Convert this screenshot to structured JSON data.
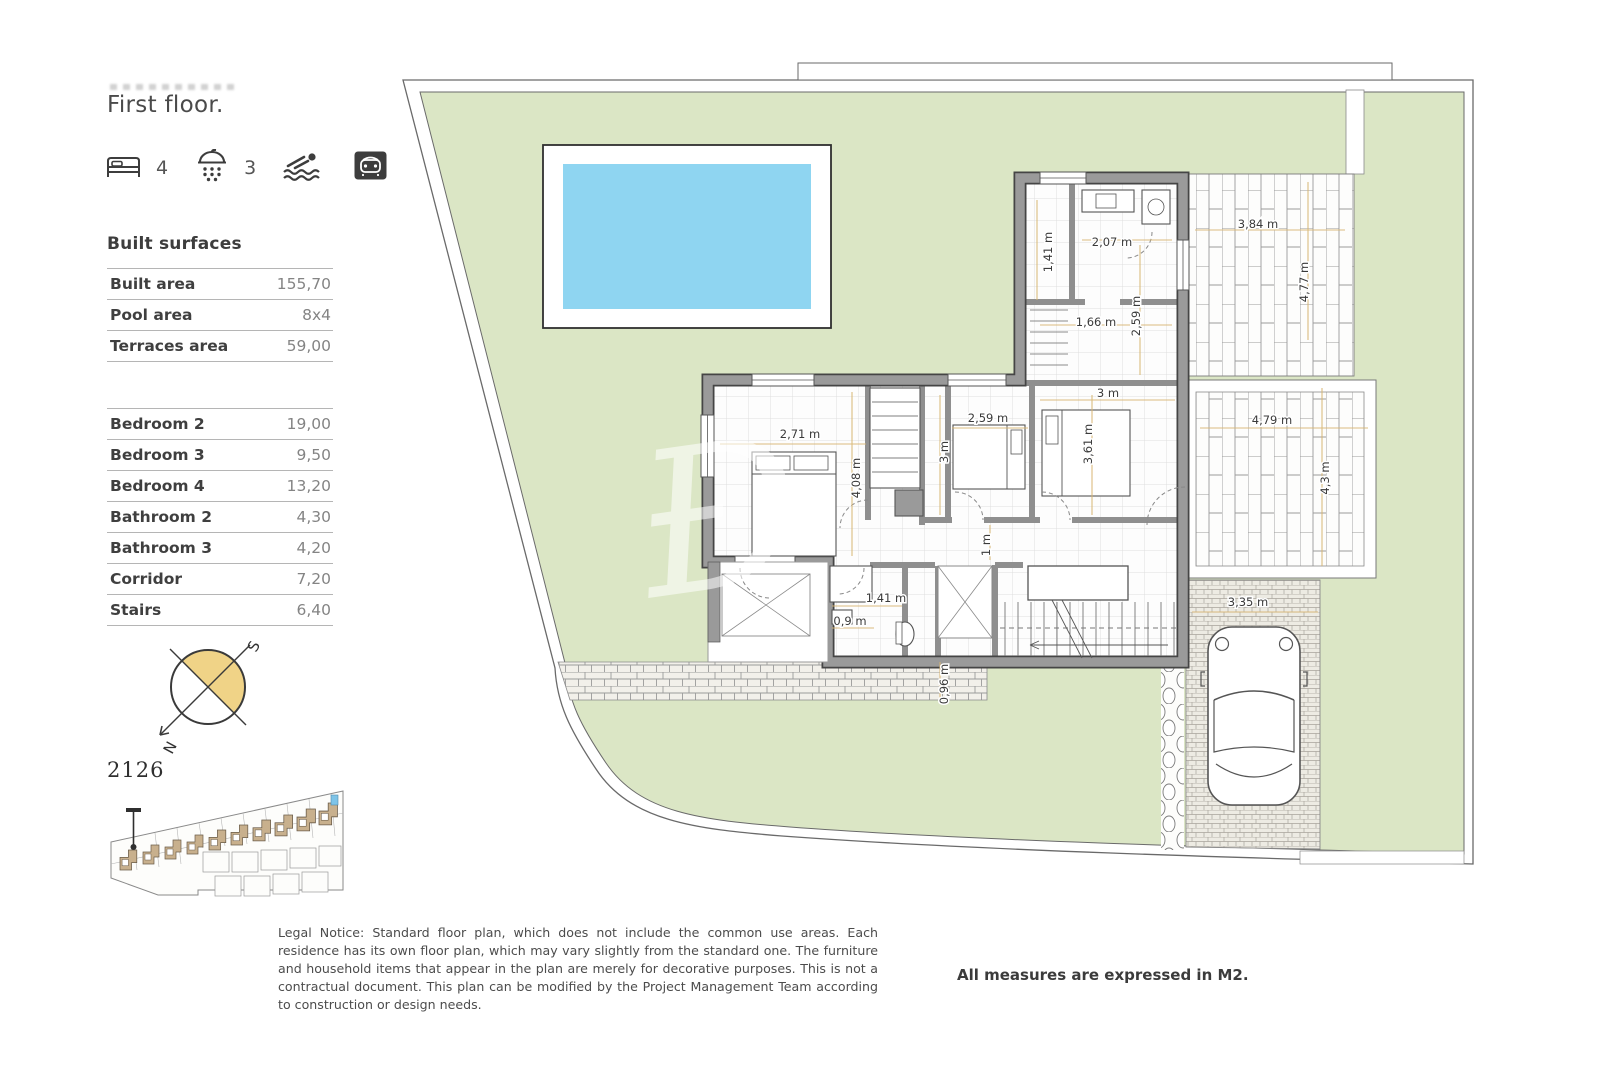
{
  "header": {
    "title": "First floor.",
    "amenities": {
      "bedrooms": "4",
      "bathrooms": "3"
    }
  },
  "built_surfaces": {
    "heading": "Built surfaces",
    "rows": [
      {
        "label": "Built area",
        "value": "155,70"
      },
      {
        "label": "Pool area",
        "value": "8x4"
      },
      {
        "label": "Terraces area",
        "value": "59,00"
      }
    ],
    "rooms": [
      {
        "label": "Bedroom 2",
        "value": "19,00"
      },
      {
        "label": "Bedroom 3",
        "value": "9,50"
      },
      {
        "label": "Bedroom 4",
        "value": "13,20"
      },
      {
        "label": "Bathroom 2",
        "value": "4,30"
      },
      {
        "label": "Bathroom 3",
        "value": "4,20"
      },
      {
        "label": "Corridor",
        "value": "7,20"
      },
      {
        "label": "Stairs",
        "value": "6,40"
      }
    ]
  },
  "compass": {
    "north": "N",
    "south": "S"
  },
  "site": {
    "unit_number": "2126"
  },
  "plan": {
    "watermark": "Đ",
    "dims": [
      {
        "text": "1,41 m"
      },
      {
        "text": "2,07 m"
      },
      {
        "text": "3,84 m"
      },
      {
        "text": "4,77 m"
      },
      {
        "text": "1,66 m"
      },
      {
        "text": "2,59 m"
      },
      {
        "text": "3 m"
      },
      {
        "text": "2,71 m"
      },
      {
        "text": "2,59 m"
      },
      {
        "text": "3 m"
      },
      {
        "text": "3,61 m"
      },
      {
        "text": "4,79 m"
      },
      {
        "text": "4,3 m"
      },
      {
        "text": "4,08 m"
      },
      {
        "text": "1 m"
      },
      {
        "text": "1,41 m"
      },
      {
        "text": "0,9 m"
      },
      {
        "text": "0,96 m"
      },
      {
        "text": "3,35 m"
      }
    ]
  },
  "footer": {
    "legal": "Legal Notice: Standard floor plan, which does not include the common use areas. Each residence has its own floor plan, which may vary slightly from the standard one. The furniture and household items that appear in the plan are merely for decorative purposes. This is not a contractual document. This plan can be modified by the Project Management Team according to construction or design needs.",
    "measures_note": "All measures are expressed in M2."
  },
  "colors": {
    "lawn": "#dbe6c5",
    "pool": "#8fd5f1",
    "wall": "#9a9a9a",
    "dimension_line": "#d8b572",
    "compass_accent": "#f0d387",
    "site_house": "#c8b08d"
  }
}
